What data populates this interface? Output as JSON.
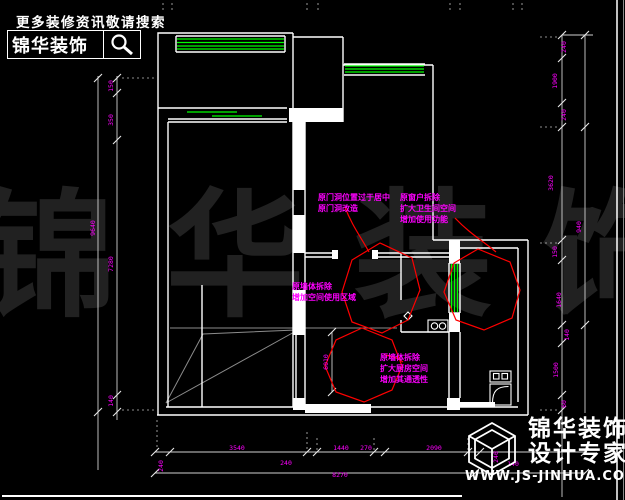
{
  "header": {
    "tagline": "更多装修资讯敬请搜索",
    "brand": "锦华装饰"
  },
  "watermark": "锦华装饰",
  "annotations": {
    "door": {
      "l1": "原门洞位置过于居中",
      "l2": "原门洞改造"
    },
    "window": {
      "l1": "原窗户拆除",
      "l2": "扩大卫生间空间",
      "l3": "增加使用功能"
    },
    "wall": {
      "l1": "原墙体拆除",
      "l2": "增加空间使用区域"
    },
    "kitchen": {
      "l1": "原墙体拆除",
      "l2": "扩大厨房空间",
      "l3": "增加其通透性"
    }
  },
  "dims": {
    "left": [
      "150",
      "350",
      "9640",
      "7280",
      "140"
    ],
    "right": [
      "240",
      "1900",
      "240",
      "3620",
      "940",
      "150",
      "1640",
      "140",
      "1500",
      "60"
    ],
    "bottom": [
      "240",
      "3540",
      "240",
      "1440",
      "270",
      "2090",
      "240",
      "140"
    ],
    "bottom_total": "8270",
    "inner": "6010"
  },
  "footer": {
    "brand_line1": "锦华装饰",
    "brand_line2": "设计专家",
    "website": "WWW.JS-JINHUA.COM"
  },
  "colors": {
    "background": "#000000",
    "walls": "#ffffff",
    "window_green": "#00ff00",
    "dimension_magenta": "#ff00ff",
    "revision_red": "#ff0000",
    "watermark_gray": "#212121"
  }
}
